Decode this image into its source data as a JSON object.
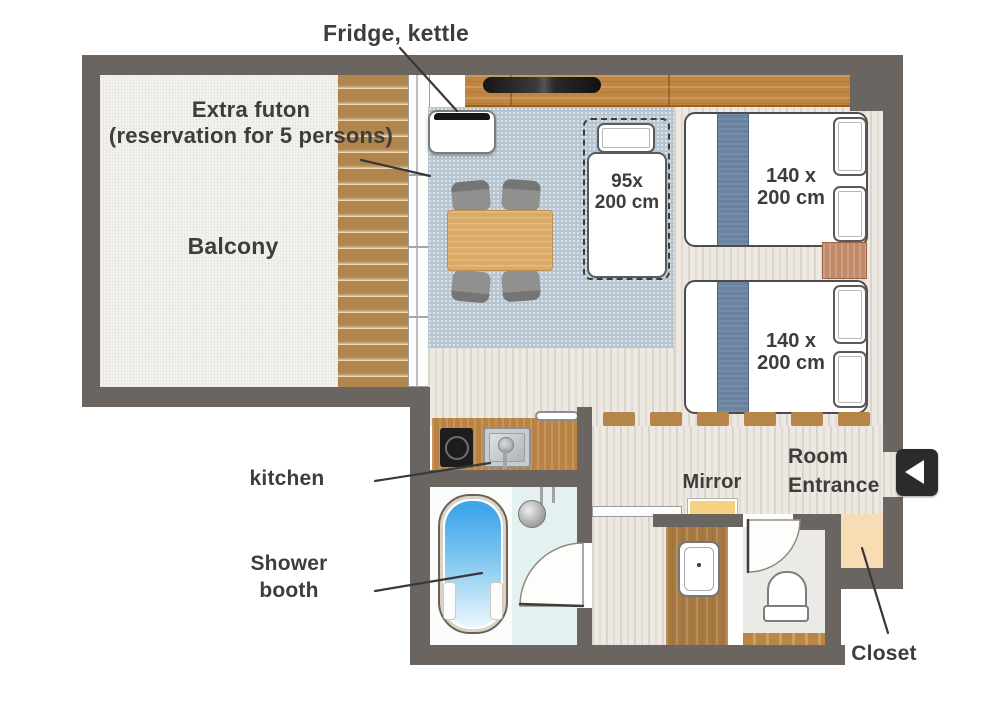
{
  "title": "Room floor plan",
  "labels": {
    "fridge_kettle": "Fridge, kettle",
    "extra_futon_line1": "Extra futon",
    "extra_futon_line2": "(reservation for 5 persons)",
    "balcony": "Balcony",
    "kitchen": "kitchen",
    "shower_booth_line1": "Shower",
    "shower_booth_line2": "booth",
    "mirror": "Mirror",
    "room_entrance_line1": "Room",
    "room_entrance_line2": "Entrance",
    "closet": "Closet"
  },
  "sizes": {
    "futon_line1": "95x",
    "futon_line2": "200 cm",
    "bed1_line1": "140 x",
    "bed1_line2": "200 cm",
    "bed2_line1": "140 x",
    "bed2_line2": "200 cm"
  },
  "icons": {
    "entrance_arrow": "left-pointing-triangle"
  },
  "colors": {
    "wall": "#6b6561",
    "carpet": "#b5c6d2",
    "deck_wood": "#b98c55",
    "counter_wood": "#c08640",
    "bed_runner": "#68829f",
    "tub_water": "#3fa5ea",
    "closet_fill": "#f7dcb4",
    "mirror_fill": "#f6d280",
    "bathroom_floor": "#e4f1f1",
    "entrance_icon_bg": "#2d2b2a",
    "text": "#3f3d3c"
  }
}
